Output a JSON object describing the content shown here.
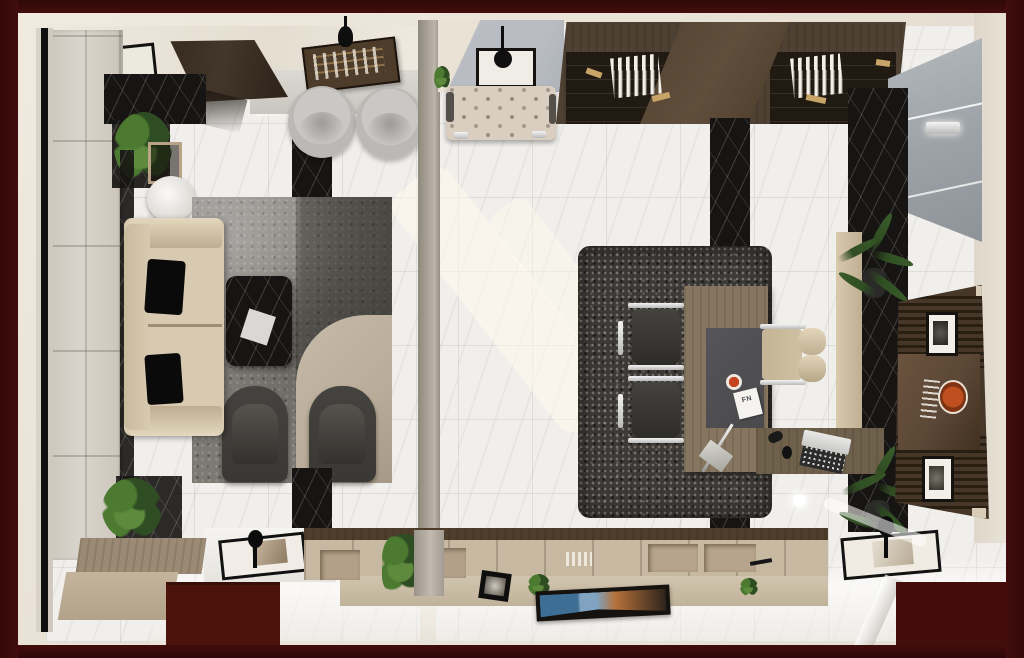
{
  "meta": {
    "title": "Top-down 3D architectural render of a two-room executive office suite",
    "view": "bird's-eye interior render",
    "visible_text": "none (photorealistic render)"
  },
  "labels": {
    "desk_paper": "FN"
  },
  "palette": {
    "border": "#420d0c",
    "borderNotch": "#4c120c",
    "wall": "#e8e1d5",
    "wallShade": "#d6cfc2",
    "floor": "#f1efec",
    "divider": "#a79f93",
    "panelWall": "#dad5cc",
    "darkRunner": "#29261f",
    "blackMarble": "#171513",
    "rugLeft": "#7d7a74",
    "rugLeftDark": "#56534e",
    "rugTan": "#b9ac99",
    "rugRight": "#3c3936",
    "sofa": "#d8cab0",
    "sofaShade": "#bdae92",
    "pillow": "#0a0a0a",
    "armchair": "#3a3834",
    "roundChair": "#bbb9b6",
    "woodDoor": "#43362a",
    "trayWood": "#4e3c2b",
    "bench": "#9b8a74",
    "benchFront": "#c4b49d",
    "credenza": "#c6b8a1",
    "credenzaFront": "#d2c5af",
    "credenzaDark": "#4e3d2b",
    "deskWood": "#86765f",
    "blotter": "#4a4a4c",
    "chairBeige": "#cfc0a3",
    "chrome": "#e9e9e9",
    "mediaWall": "#463729",
    "mediaSlat": "#281e12",
    "mediaGloss": "#5c4736",
    "logoOrange": "#bf4f1e",
    "shelfWood": "#4e4133",
    "shelfDark": "#211a13",
    "shelfCenter": "#5f4e3b",
    "bookWhite": "#f2efe8",
    "glass": "#9ba1a6",
    "plant": "#4c7a31",
    "plantDark": "#2f4d22",
    "tuftBench": "#d9cec0",
    "artBlue": "#3f6e95",
    "artOrange": "#b5713a",
    "cupRed": "#c6441f"
  },
  "rooms": {
    "lounge": {
      "name": "reception lounge (left room)",
      "objects": [
        "wall-mirror-frame",
        "entry-door",
        "wall-console-tray",
        "round-lounge-chair",
        "round-lounge-chair",
        "black-marble-console",
        "potted-plant",
        "round-side-table",
        "beige-sofa",
        "black-cushion",
        "black-cushion",
        "two-tone-area-rug",
        "black-marble-coffee-table",
        "accent-armchair",
        "accent-armchair",
        "floor-plant",
        "wood-bench",
        "black-serving-tray",
        "paneled-wall",
        "dark-floor-runner"
      ]
    },
    "office": {
      "name": "executive office (right room)",
      "objects": [
        "display-shelving-with-books",
        "tufted-bench",
        "wall-frame-with-pendant",
        "glass-wall-panel",
        "wall-sconce",
        "charcoal-area-rug",
        "conference-chair",
        "conference-chair",
        "executive-desk",
        "desk-blotter",
        "coffee-cup",
        "document",
        "executive-chair",
        "laptop",
        "desk-lamp",
        "black-marble-feature-wall",
        "palm-plant",
        "palm-plant",
        "slatted-media-wall",
        "orange-logo-plate",
        "picture-frame",
        "picture-frame",
        "bottom-credenza",
        "canvas-painting",
        "display-tray",
        "dark-floor-runner"
      ]
    }
  }
}
